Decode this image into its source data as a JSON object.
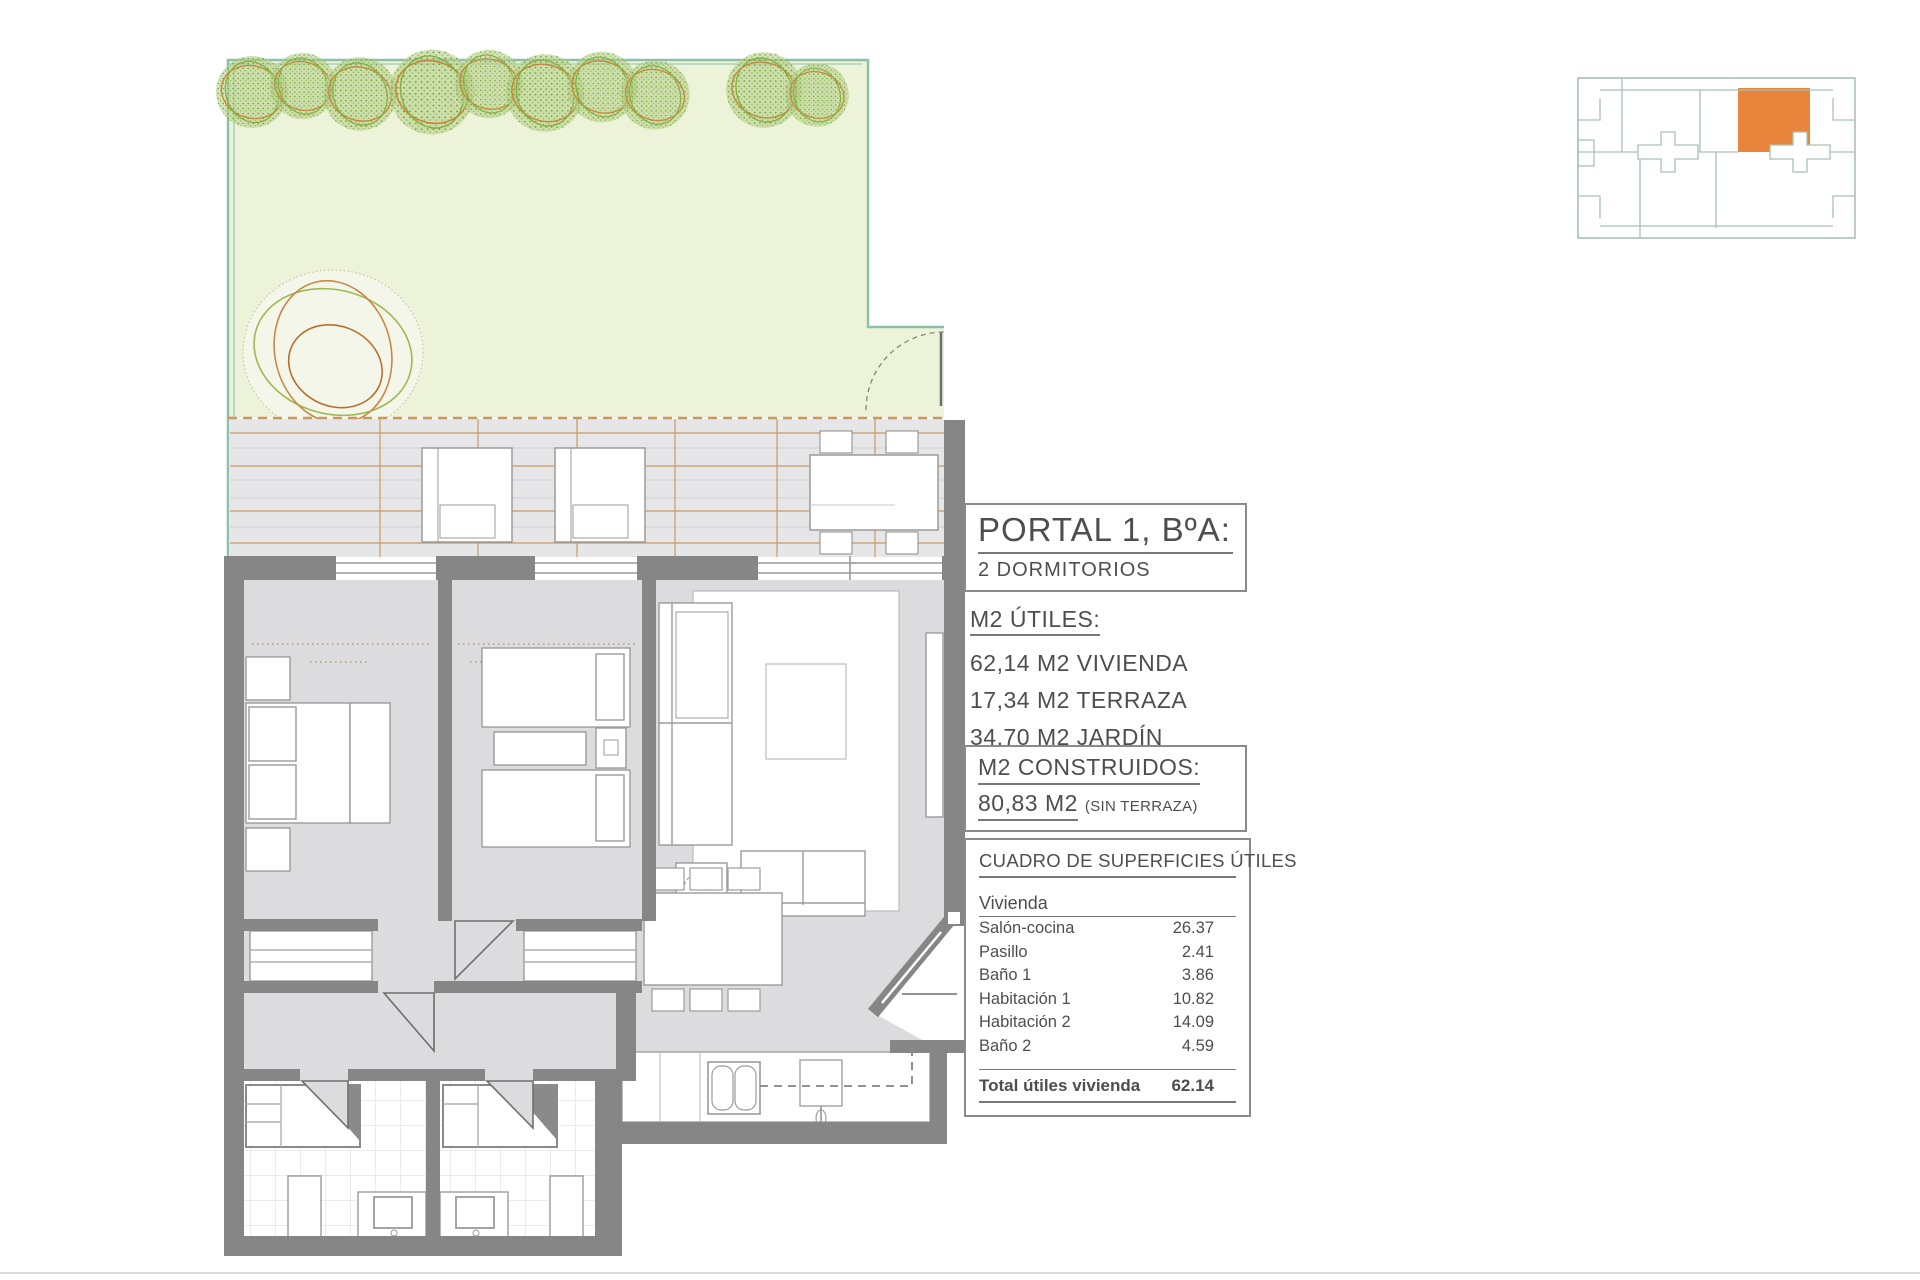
{
  "header": {
    "portal_title": "PORTAL 1, BºA:",
    "portal_subtitle": "2 DORMITORIOS"
  },
  "m2_utiles": {
    "title": "M2 ÚTILES:",
    "lines": [
      "62,14 M2 VIVIENDA",
      "17,34 M2 TERRAZA",
      "34,70 M2 JARDÍN"
    ]
  },
  "m2_construidos": {
    "title": "M2 CONSTRUIDOS:",
    "value": "80,83 M2",
    "note": "(SIN TERRAZA)"
  },
  "surface_table": {
    "title": "CUADRO DE SUPERFICIES ÚTILES",
    "group_label": "Vivienda",
    "rows": [
      {
        "label": "Salón-cocina",
        "value": "26.37"
      },
      {
        "label": "Pasillo",
        "value": "2.41"
      },
      {
        "label": "Baño 1",
        "value": "3.86"
      },
      {
        "label": "Habitación 1",
        "value": "10.82"
      },
      {
        "label": "Habitación 2",
        "value": "14.09"
      },
      {
        "label": "Baño 2",
        "value": "4.59"
      }
    ],
    "total_label": "Total útiles vivienda",
    "total_value": "62.14"
  },
  "colors": {
    "highlight_unit_orange": "#E8843C",
    "garden_green": "#EDF3D8",
    "fence_teal": "#8EBFAB",
    "wall_gray": "#868686",
    "floor_gray": "#DCDCDE",
    "terrace_gray": "#E6E6E8",
    "deck_line_tan": "#C79A63",
    "text_gray": "#4E4E4E"
  }
}
